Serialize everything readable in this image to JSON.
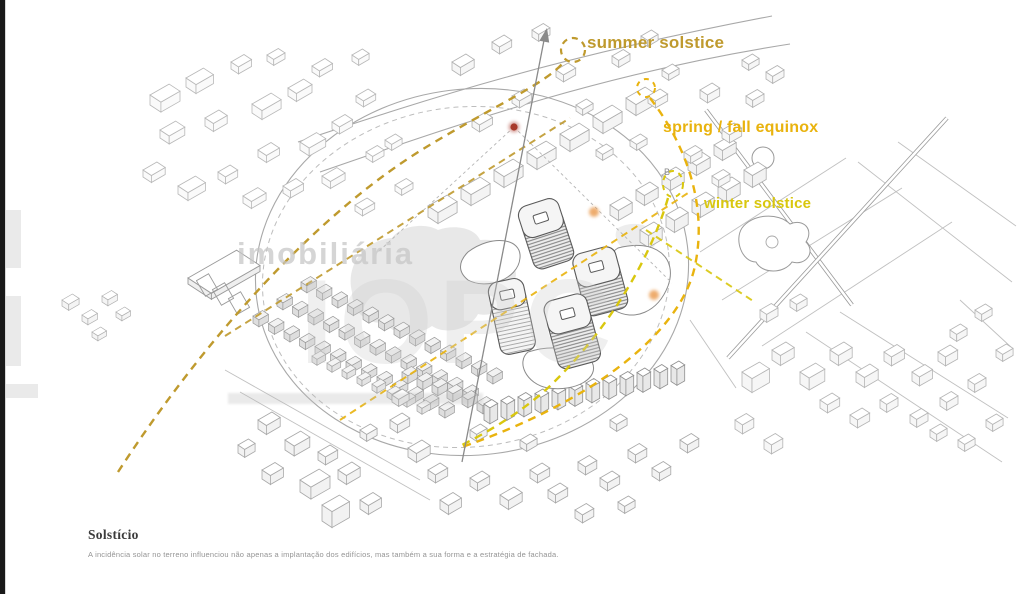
{
  "diagram": {
    "sun_paths": [
      {
        "id": "summer",
        "label": "summer solstice",
        "color": "#bf9a2e"
      },
      {
        "id": "equinox",
        "label": "spring / fall equinox",
        "color": "#e9b30e"
      },
      {
        "id": "winter",
        "label": "winter solstice",
        "color": "#d9c70e"
      }
    ],
    "markers": {
      "north_point_color": "#a8392a",
      "sun_dot_color": "#e8913c",
      "point_label": "B"
    },
    "drawing_ink": "#a8a8a8"
  },
  "watermark": {
    "line1": "imobiliária",
    "line2": "IOPC"
  },
  "caption": {
    "title": "Solstício",
    "body": "A incidência solar no terreno influenciou não apenas a implantação dos edifícios, mas também a sua forma e a estratégia de fachada."
  }
}
